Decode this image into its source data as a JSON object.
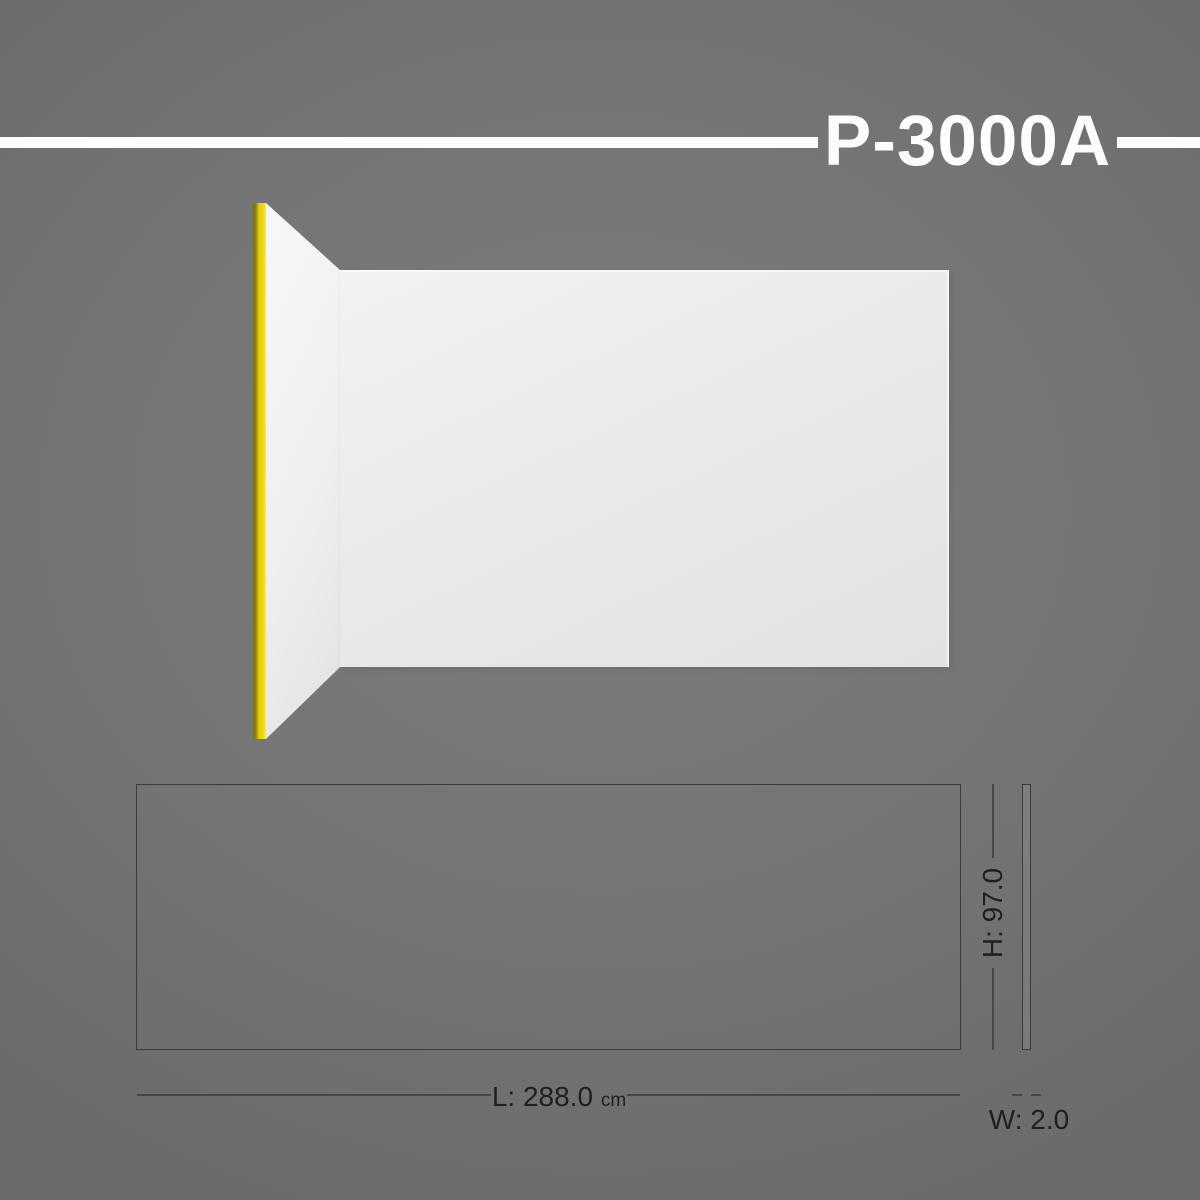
{
  "header": {
    "title": "P-3000A"
  },
  "drawing": {
    "length": {
      "label": "L: 288.0",
      "unit": "cm"
    },
    "height": {
      "label": "H: 97.0"
    },
    "width": {
      "label": "W: 2.0"
    }
  },
  "colors": {
    "background": "#747474",
    "accent_yellow": "#e8d20e",
    "panel_white": "#ededef",
    "title_white": "#fdfdfd",
    "drawing_line": "#3c3c3c",
    "label_text": "#1f1f1f"
  }
}
